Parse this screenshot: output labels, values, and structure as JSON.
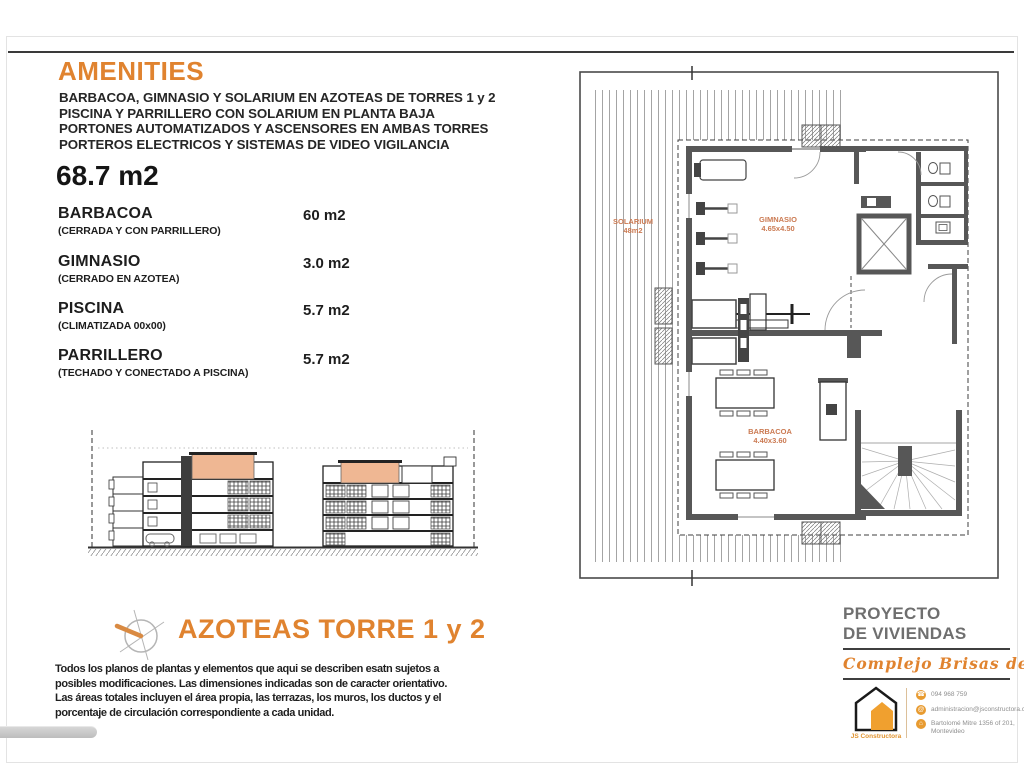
{
  "colors": {
    "accent": "#E0832F",
    "plan_label": "#CB7A52",
    "roof_highlight": "#EFB793"
  },
  "header": {
    "title": "AMENITIES",
    "lines": [
      "BARBACOA, GIMNASIO Y SOLARIUM  EN AZOTEAS DE TORRES 1 y 2",
      "PISCINA Y PARRILLERO CON SOLARIUM EN PLANTA BAJA",
      "PORTONES AUTOMATIZADOS Y ASCENSORES EN AMBAS TORRES",
      "PORTEROS ELECTRICOS Y SISTEMAS DE VIDEO VIGILANCIA"
    ]
  },
  "total_area": "68.7 m2",
  "amenities": [
    {
      "name": "BARBACOA",
      "note": "(CERRADA Y CON PARRILLERO)",
      "area": "60 m2"
    },
    {
      "name": "GIMNASIO",
      "note": "(CERRADO EN AZOTEA)",
      "area": "3.0 m2"
    },
    {
      "name": "PISCINA",
      "note": "(CLIMATIZADA 00x00)",
      "area": "5.7 m2"
    },
    {
      "name": "PARRILLERO",
      "note": "(TECHADO Y CONECTADO A PISCINA)",
      "area": "5.7 m2"
    }
  ],
  "plan": {
    "title": "AZOTEAS TORRE 1 y 2",
    "labels": {
      "solarium": {
        "name": "SOLARIUM",
        "dim": "48m2"
      },
      "gimnasio": {
        "name": "GIMNASIO",
        "dim": "4.65x4.50"
      },
      "barbacoa": {
        "name": "BARBACOA",
        "dim": "4.40x3.60"
      }
    }
  },
  "disclaimer": [
    "Todos los planos de plantas y elementos que aqui se describen esatn sujetos a",
    "posibles modificaciones.  Las dimensiones indicadas son de caracter orientativo.",
    "Las áreas totales incluyen el área propia, las terrazas, los muros, los ductos y el",
    "porcentaje de circulación correspondiente a cada unidad."
  ],
  "footer": {
    "project_line1": "PROYECTO",
    "project_line2": "DE VIVIENDAS",
    "complex_name": "Complejo Brisas de Pando",
    "company": "JS Constructora",
    "phone": "094 968 759",
    "email": "administracion@jsconstructora.com",
    "address_line1": "Bartolomé Mitre 1356 of 201,",
    "address_line2": "Montevideo"
  }
}
